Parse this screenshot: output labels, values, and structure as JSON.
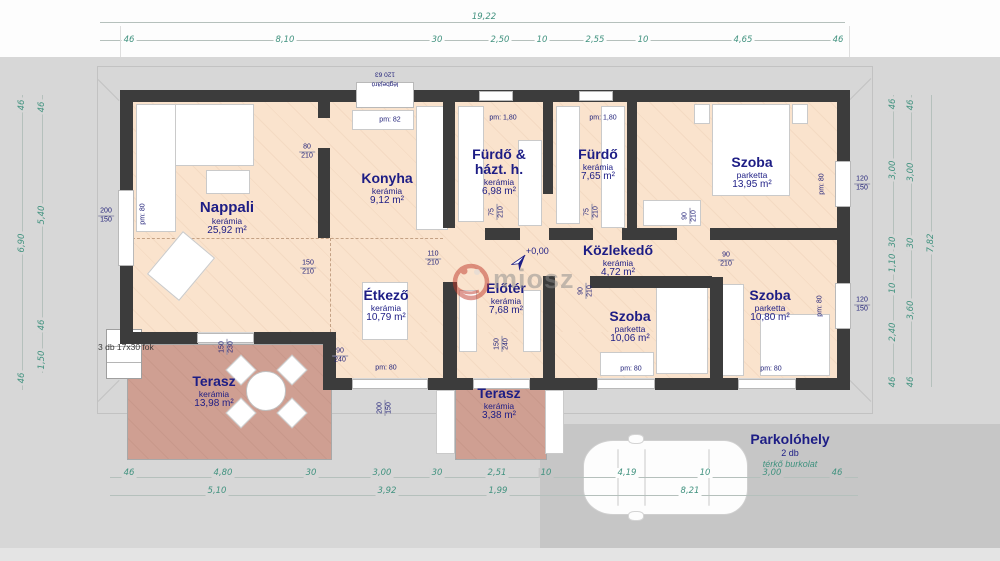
{
  "watermark": {
    "text": "miosz"
  },
  "rooms": [
    {
      "name": "Nappali",
      "material": "kerámia",
      "area": "25,92 m²"
    },
    {
      "name": "Konyha",
      "material": "kerámia",
      "area": "9,12 m²"
    },
    {
      "name": "Fürdő & házt. h.",
      "material": "kerámia",
      "area": "6,98 m²"
    },
    {
      "name": "Fürdő",
      "material": "kerámia",
      "area": "7,65 m²"
    },
    {
      "name": "Szoba",
      "material": "parketta",
      "area": "13,95 m²"
    },
    {
      "name": "Közlekedő",
      "material": "kerámia",
      "area": "4,72 m²"
    },
    {
      "name": "Étkező",
      "material": "kerámia",
      "area": "10,79 m²"
    },
    {
      "name": "Előtér",
      "material": "kerámia",
      "area": "7,68 m²"
    },
    {
      "name": "Szoba",
      "material": "parketta",
      "area": "10,06 m²"
    },
    {
      "name": "Szoba",
      "material": "parketta",
      "area": "10,80 m²"
    },
    {
      "name": "Terasz",
      "material": "kerámia",
      "area": "13,98 m²"
    },
    {
      "name": "Terasz",
      "material": "kerámia",
      "area": "3,38 m²"
    }
  ],
  "parking": {
    "name": "Parkolóhely",
    "count": "2 db",
    "surface": "térkő burkolat"
  },
  "stairs_note": "3 db 17x30 fok",
  "level_marker": "+0,00",
  "vent": {
    "size": "120  63",
    "text": "légbejáró"
  },
  "dims": {
    "top_total": "19,22",
    "top": [
      "46",
      "8,10",
      "30",
      "2,50",
      "10",
      "2,55",
      "10",
      "4,65",
      "46"
    ],
    "left_outer": [
      "46",
      "6,90",
      "46"
    ],
    "left_inner": [
      "46",
      "5,40",
      "46",
      "1,50"
    ],
    "right_inner": [
      "46",
      "3,00",
      "30",
      "1,10",
      "10",
      "2,40",
      "46"
    ],
    "right_mid": [
      "46",
      "3,00",
      "30",
      "3,60",
      "46"
    ],
    "right_total": "7,82",
    "bottom_row1": [
      "46",
      "4,80",
      "30",
      "3,00",
      "30",
      "2,51",
      "10",
      "4,19",
      "10",
      "3,00",
      "46"
    ],
    "bottom_row2": [
      "5,10",
      "3,92",
      "1,99",
      "8,21"
    ]
  },
  "size_labels": [
    {
      "w": "200",
      "h": "150"
    },
    {
      "w": "80",
      "h": "210"
    },
    {
      "w": "150",
      "h": "210"
    },
    {
      "w": "110",
      "h": "210"
    },
    {
      "w": "75",
      "h": "210"
    },
    {
      "w": "75",
      "h": "210"
    },
    {
      "w": "90",
      "h": "210"
    },
    {
      "w": "90",
      "h": "210"
    },
    {
      "w": "90",
      "h": "210"
    },
    {
      "w": "120",
      "h": "150"
    },
    {
      "w": "120",
      "h": "150"
    },
    {
      "w": "90",
      "h": "240"
    },
    {
      "w": "150",
      "h": "240"
    },
    {
      "w": "150",
      "h": "230"
    },
    {
      "w": "200",
      "h": "150"
    }
  ],
  "pm_labels": [
    "pm: 82",
    "pm: 1,80",
    "pm: 1,80",
    "pm: 80",
    "pm: 80",
    "pm: 80",
    "pm: 80",
    "pm: 80",
    "pm: 80"
  ],
  "colors": {
    "wall": "#3c3c3c",
    "floor": "#fae3cd",
    "terrace": "#cf9f92",
    "label_navy": "#1d1d85",
    "dim_teal": "#41927f",
    "background": "#d7d7d7",
    "parking_area": "#c6c6c6",
    "watermark_red": "#c0392b"
  }
}
